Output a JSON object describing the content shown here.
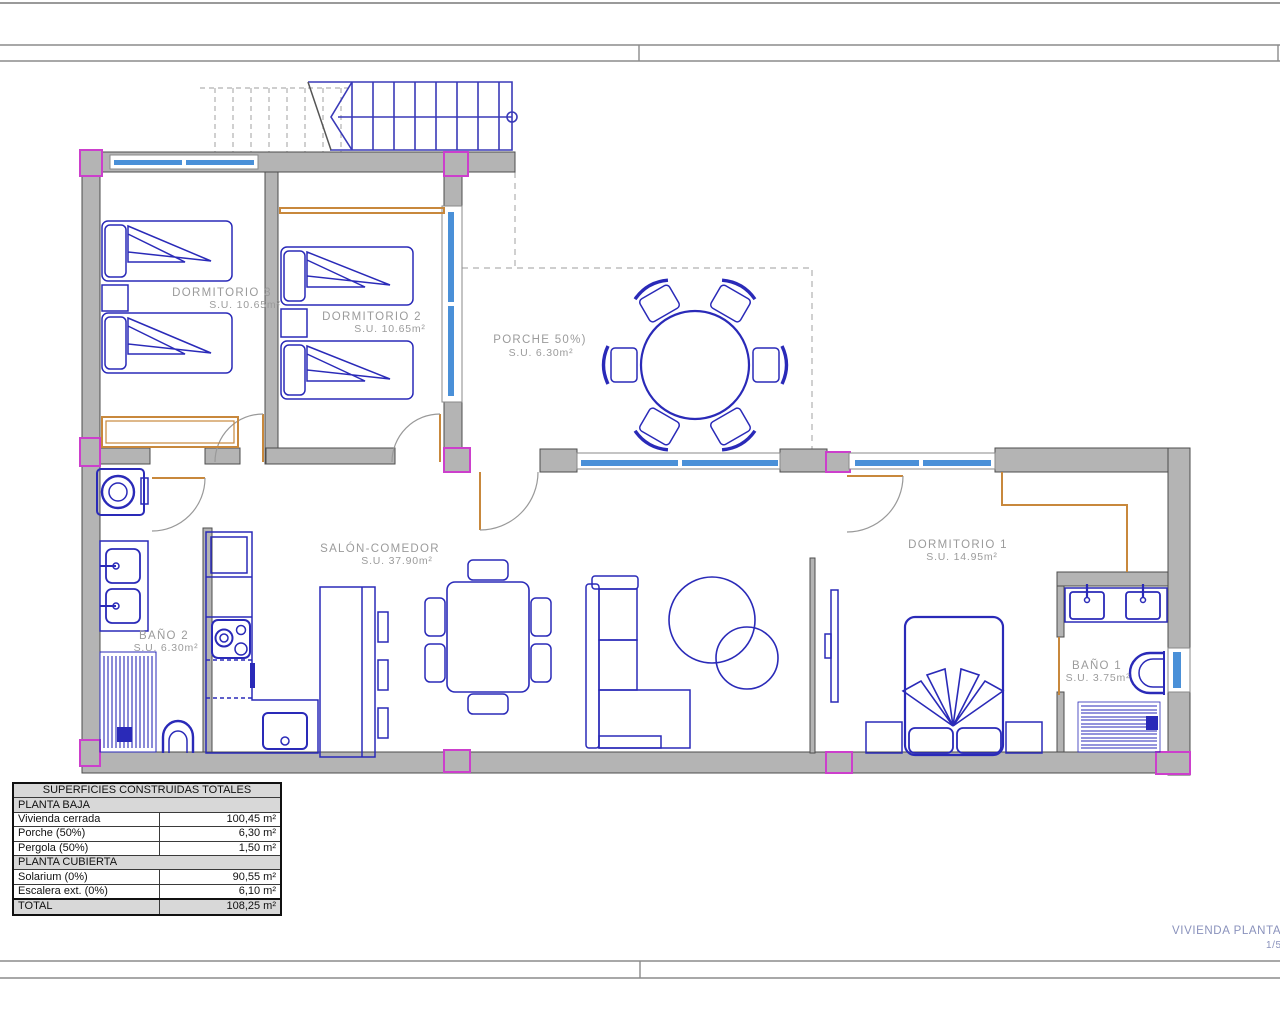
{
  "sheet": {
    "title": "VIVIENDA PLANTA BA",
    "number": "1/5"
  },
  "rooms": [
    {
      "name": "DORMITORIO 3",
      "area": "S.U. 10.65m²"
    },
    {
      "name": "DORMITORIO 2",
      "area": "S.U. 10.65m²"
    },
    {
      "name": "PORCHE 50%)",
      "area": "S.U. 6.30m²"
    },
    {
      "name": "SALÓN-COMEDOR",
      "area": "S.U. 37.90m²"
    },
    {
      "name": "BAÑO 2",
      "area": "S.U. 6.30m²"
    },
    {
      "name": "DORMITORIO 1",
      "area": "S.U. 14.95m²"
    },
    {
      "name": "BAÑO 1",
      "area": "S.U. 3.75m²"
    }
  ],
  "areas_table": {
    "title": "SUPERFICIES CONSTRUIDAS TOTALES",
    "planta_baja_header": "PLANTA BAJA",
    "planta_baja_rows": [
      [
        "Vivienda cerrada",
        "100,45 m²"
      ],
      [
        "Porche (50%)",
        "6,30 m²"
      ],
      [
        "Pergola (50%)",
        "1,50 m²"
      ]
    ],
    "planta_cubierta_header": "PLANTA CUBIERTA",
    "planta_cubierta_rows": [
      [
        "Solarium (0%)",
        "90,55 m²"
      ],
      [
        "Escalera ext. (0%)",
        "6,10 m²"
      ]
    ],
    "total_label": "TOTAL",
    "total_value": "108,25 m²"
  },
  "colors": {
    "wall": "#b4b4b4",
    "wall_line": "#4d4d4d",
    "furniture_blue": "#2a2ab8",
    "stairs_blue": "#3a3ab8",
    "window_blue": "#4a90d8",
    "pillar_magenta": "#cc3fcc",
    "wardrobe_orange": "#c8883c",
    "label_gray": "#9b9b9b",
    "title_blue": "#8a92bc"
  }
}
